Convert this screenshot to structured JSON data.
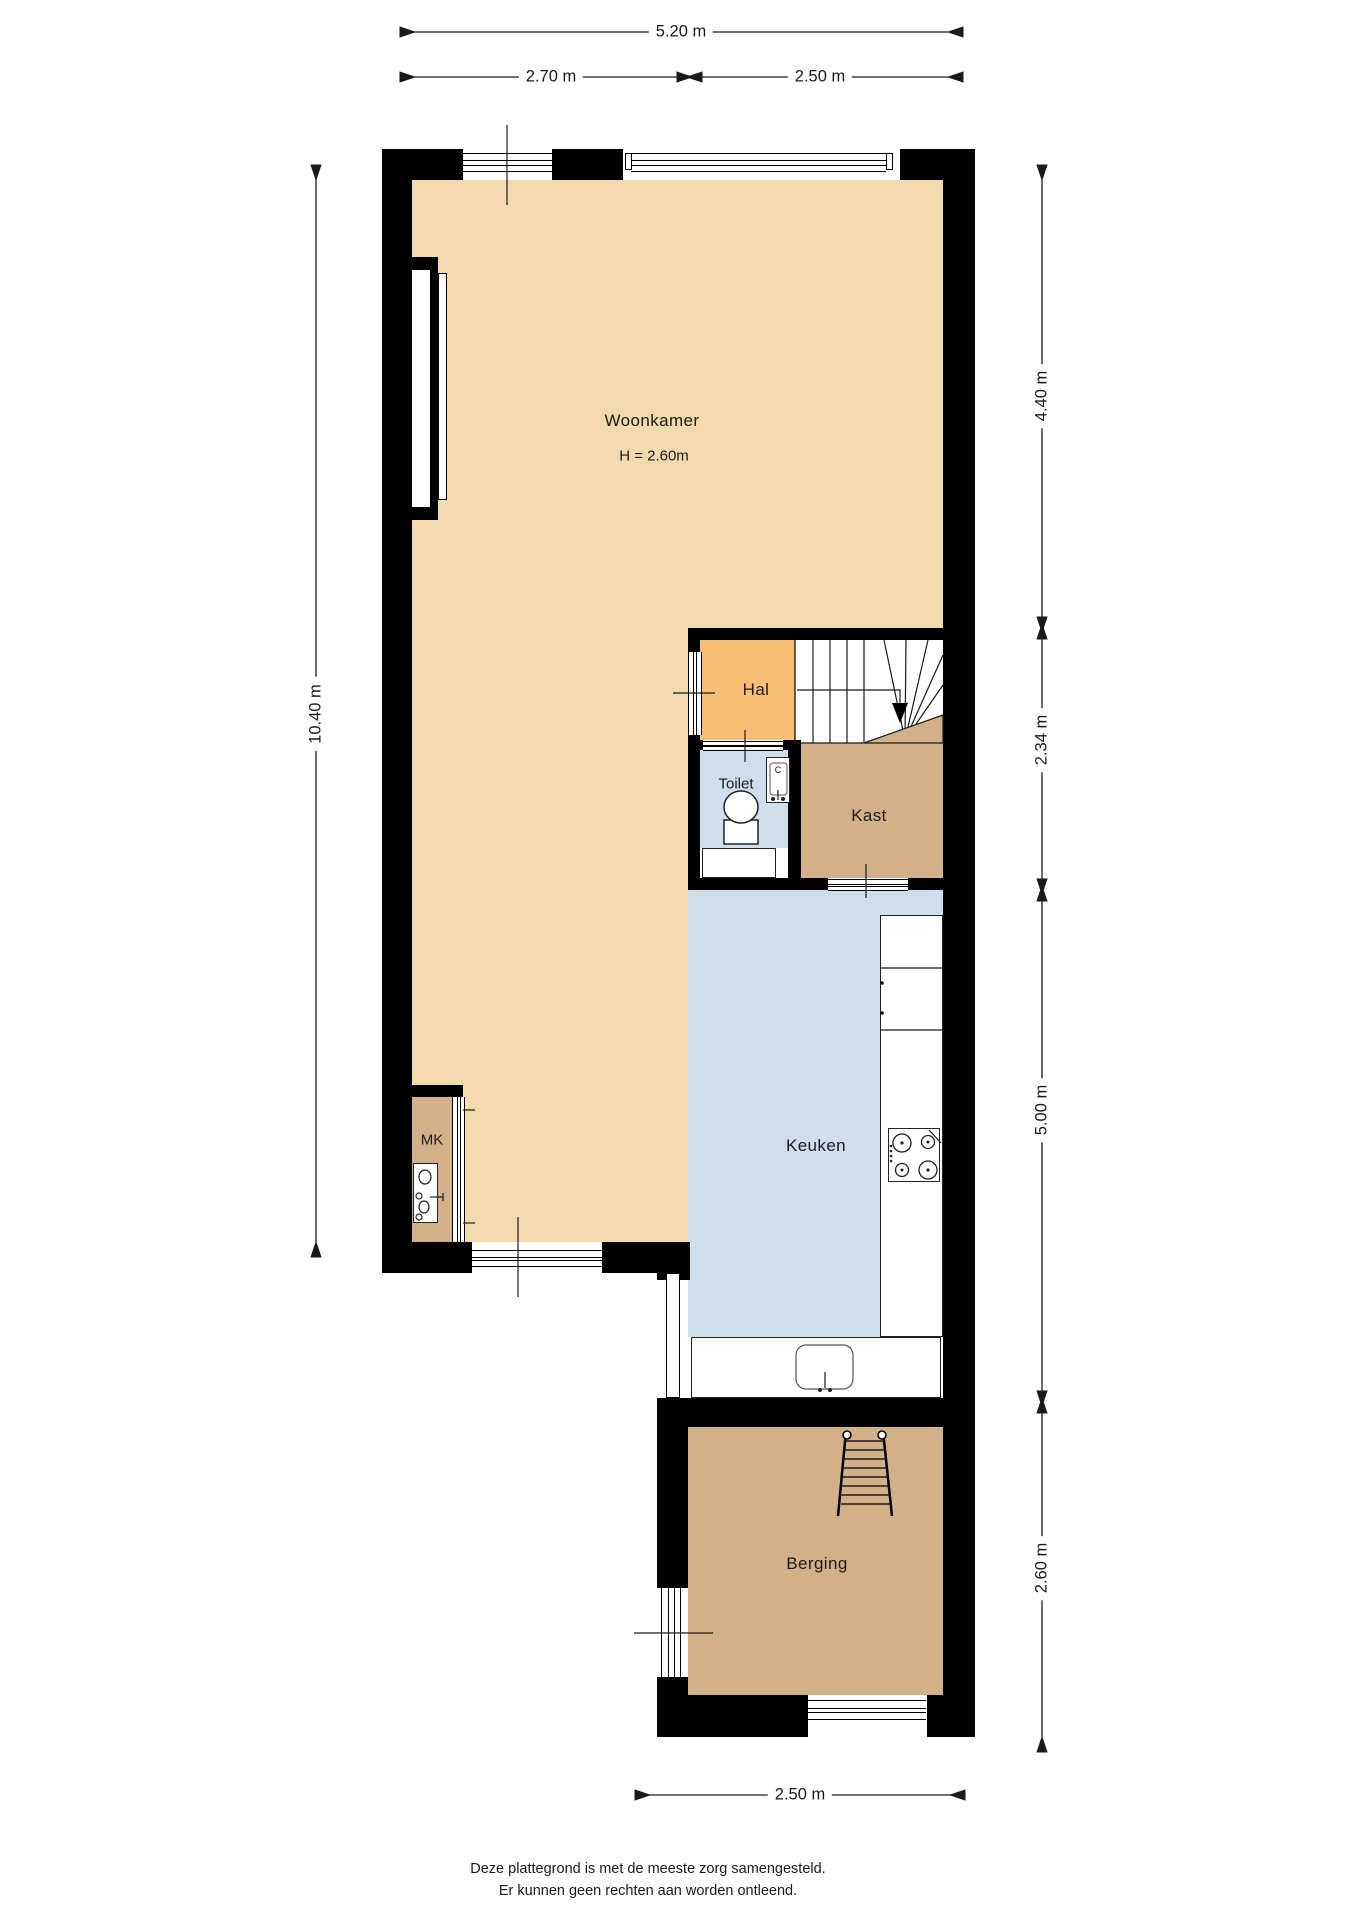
{
  "colors": {
    "floor_beige": "#F2DAAD",
    "floor_orange": "#F7BE75",
    "floor_blue": "#CEDEEC",
    "floor_tan": "#D2B189",
    "wall": "#000000",
    "line": "#1A1A1A",
    "text": "#1A1A1A"
  },
  "rooms": {
    "woonkamer": {
      "label": "Woonkamer",
      "height_note": "H = 2.60m"
    },
    "hal": {
      "label": "Hal"
    },
    "toilet": {
      "label": "Toilet"
    },
    "kast": {
      "label": "Kast"
    },
    "keuken": {
      "label": "Keuken"
    },
    "mk": {
      "label": "MK"
    },
    "berging": {
      "label": "Berging"
    }
  },
  "fixtures": {
    "boiler_label": "C"
  },
  "dimensions": {
    "top_total": "5.20 m",
    "top_segment_left": "2.70 m",
    "top_segment_right": "2.50 m",
    "left_total": "10.40 m",
    "right_woonkamer": "4.40 m",
    "right_hal": "2.34 m",
    "right_keuken": "5.00 m",
    "right_berging": "2.60 m",
    "bottom_berging": "2.50 m"
  },
  "footer": {
    "line1": "Deze plattegrond is met de meeste zorg samengesteld.",
    "line2": "Er kunnen geen rechten aan worden ontleend."
  }
}
